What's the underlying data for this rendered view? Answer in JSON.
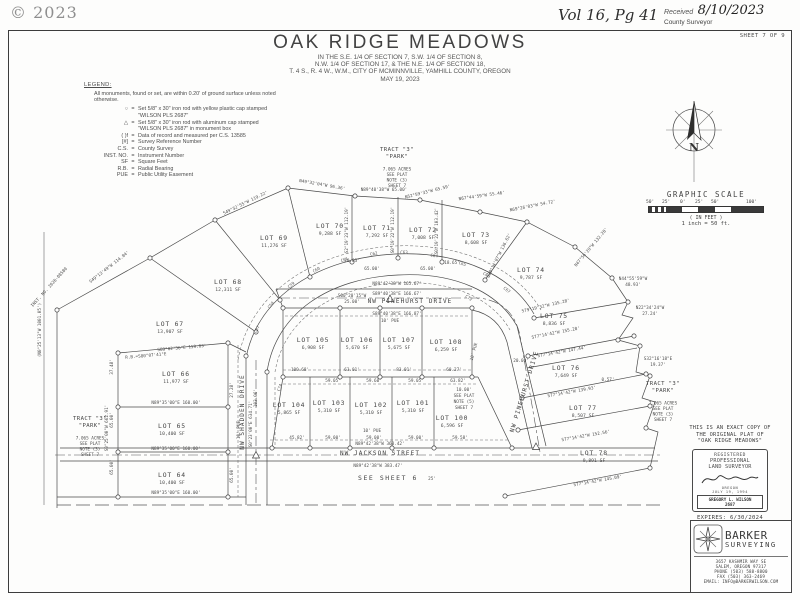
{
  "page": {
    "copyright": "© 2023",
    "vol": "Vol 16, Pg 41",
    "received_label": "Received",
    "received_date": "8/10/2023",
    "county_surveyor": "County Surveyor",
    "sheet": "SHEET 7 OF 9"
  },
  "title": {
    "main": "OAK RIDGE MEADOWS",
    "sub1": "IN THE S.E. 1/4 OF SECTION 7, S.W. 1/4 OF SECTION 8,",
    "sub2": "N.W. 1/4 OF SECTION 17, & THE N.E. 1/4 OF SECTION 18,",
    "sub3": "T. 4 S., R. 4 W., W.M., CITY OF MCMINNVILLE, YAMHILL COUNTY, OREGON",
    "sub4": "MAY 19, 2023"
  },
  "legend": {
    "heading": "LEGEND:",
    "note": "All monuments, found or set, are within 0.20' of ground surface unless noted otherwise.",
    "eq": "=",
    "items": [
      {
        "symbol": "○",
        "lines": [
          "Set 5/8\" x 30\" iron rod with yellow plastic cap stamped",
          "\"WILSON PLS 2687\""
        ]
      },
      {
        "symbol": "△",
        "lines": [
          "Set 5/8\" x 30\" iron rod with aluminum cap stamped",
          "\"WILSON PLS 2687\" in monument box"
        ]
      },
      {
        "symbol": "( )f",
        "lines": [
          "Data of record and measured per C.S. 13585"
        ]
      },
      {
        "symbol": "[#]",
        "lines": [
          "Survey Reference Number"
        ]
      },
      {
        "symbol": "C.S.",
        "lines": [
          "County Survey"
        ]
      },
      {
        "symbol": "INST. NO.",
        "lines": [
          "Instrument Number"
        ]
      },
      {
        "symbol": "SF",
        "lines": [
          "Square Feet"
        ]
      },
      {
        "symbol": "R.B.",
        "lines": [
          "Radial Bearing"
        ]
      },
      {
        "symbol": "PUE",
        "lines": [
          "Public Utility Easement"
        ]
      }
    ]
  },
  "compass": {
    "letter": "N"
  },
  "scale": {
    "title": "GRAPHIC SCALE",
    "ticks": [
      "50'",
      "25'",
      "0'",
      "25'",
      "50'",
      "100'"
    ],
    "feet": "( IN FEET )",
    "ratio": "1 inch = 50 ft."
  },
  "certification": {
    "l1": "THIS IS AN EXACT COPY OF",
    "l2": "THE ORIGINAL PLAT OF",
    "l3": "\"OAK RIDGE MEADOWS\"",
    "stamp": {
      "registered": "REGISTERED",
      "professional": "PROFESSIONAL",
      "land_surveyor": "LAND SURVEYOR",
      "state": "OREGON",
      "date": "JULY 19, 1994",
      "name": "GREGORY L. WILSON",
      "number": "2687"
    },
    "expires": "EXPIRES: 6/30/2024"
  },
  "firm": {
    "name": "BARKER",
    "type": "SURVEYING",
    "address1": "3657 KASHMIR WAY SE",
    "address2": "SALEM, OREGON 97317",
    "phone": "PHONE (503) 588-8800",
    "fax": "FAX (503) 363-2469",
    "email": "EMAIL: INFO@BARKERWILSON.COM"
  },
  "map": {
    "see_sheet": "SEE SHEET 6",
    "streets": [
      {
        "name": "NW PINEHURST DRIVE",
        "x": 410,
        "y": 303,
        "r": 0
      },
      {
        "name": "NW JACKSON STREET",
        "x": 380,
        "y": 455,
        "r": 0
      },
      {
        "name": "NW SHADDEN DRIVE",
        "x": 244,
        "y": 412,
        "r": -90
      },
      {
        "name": "NW PINEHURST DRIVE",
        "x": 526,
        "y": 392,
        "r": -73
      }
    ],
    "lots": [
      {
        "name": "LOT 64",
        "sf": "10,400 SF",
        "x": 172,
        "y": 477
      },
      {
        "name": "LOT 65",
        "sf": "10,400 SF",
        "x": 172,
        "y": 428
      },
      {
        "name": "LOT 66",
        "sf": "11,977 SF",
        "x": 176,
        "y": 376
      },
      {
        "name": "LOT 67",
        "sf": "13,907 SF",
        "x": 170,
        "y": 326
      },
      {
        "name": "LOT 68",
        "sf": "12,311 SF",
        "x": 228,
        "y": 284
      },
      {
        "name": "LOT 69",
        "sf": "11,276 SF",
        "x": 274,
        "y": 240
      },
      {
        "name": "LOT 70",
        "sf": "9,288 SF",
        "x": 330,
        "y": 228
      },
      {
        "name": "LOT 71",
        "sf": "7,292 SF",
        "x": 377,
        "y": 230
      },
      {
        "name": "LOT 72",
        "sf": "7,008 SF",
        "x": 423,
        "y": 232
      },
      {
        "name": "LOT 73",
        "sf": "8,608 SF",
        "x": 476,
        "y": 237
      },
      {
        "name": "LOT 74",
        "sf": "9,787 SF",
        "x": 531,
        "y": 272
      },
      {
        "name": "LOT 75",
        "sf": "8,836 SF",
        "x": 554,
        "y": 318
      },
      {
        "name": "LOT 76",
        "sf": "7,649 SF",
        "x": 566,
        "y": 370
      },
      {
        "name": "LOT 77",
        "sf": "8,507 SF",
        "x": 583,
        "y": 410
      },
      {
        "name": "LOT 78",
        "sf": "9,891 SF",
        "x": 594,
        "y": 455
      },
      {
        "name": "LOT 100",
        "sf": "6,596 SF",
        "x": 452,
        "y": 420
      },
      {
        "name": "LOT 101",
        "sf": "5,310 SF",
        "x": 413,
        "y": 405
      },
      {
        "name": "LOT 102",
        "sf": "5,310 SF",
        "x": 371,
        "y": 407
      },
      {
        "name": "LOT 103",
        "sf": "5,310 SF",
        "x": 329,
        "y": 405
      },
      {
        "name": "LOT 104",
        "sf": "5,865 SF",
        "x": 289,
        "y": 407
      },
      {
        "name": "LOT 105",
        "sf": "6,908 SF",
        "x": 313,
        "y": 342
      },
      {
        "name": "LOT 106",
        "sf": "5,670 SF",
        "x": 357,
        "y": 342
      },
      {
        "name": "LOT 107",
        "sf": "5,675 SF",
        "x": 399,
        "y": 342
      },
      {
        "name": "LOT 108",
        "sf": "6,259 SF",
        "x": 446,
        "y": 344
      }
    ],
    "tracts": [
      {
        "x": 397,
        "y": 151,
        "lines": [
          "TRACT \"3\"",
          "\"PARK\"",
          "7.065 ACRES",
          "SEE PLAT",
          "NOTE (3)",
          "SHEET 7"
        ]
      },
      {
        "x": 90,
        "y": 420,
        "lines": [
          "TRACT \"3\"",
          "\"PARK\"",
          "7.065 ACRES",
          "SEE PLAT",
          "NOTE (3)",
          "SHEET 7"
        ]
      },
      {
        "x": 663,
        "y": 385,
        "lines": [
          "TRACT \"3\"",
          "\"PARK\"",
          "7.065 ACRES",
          "SEE PLAT",
          "NOTE (3)",
          "SHEET 7"
        ]
      }
    ],
    "bearings": [
      {
        "t": "S49°13'49\"W 114.84'",
        "x": 110,
        "y": 268,
        "r": -38
      },
      {
        "t": "S49°32'55\"W 119.22'",
        "x": 246,
        "y": 204,
        "r": -26
      },
      {
        "t": "N49°32'04\"W 96.36'",
        "x": 322,
        "y": 186,
        "r": 10
      },
      {
        "t": "N89°40'38\"W 65.00'",
        "x": 384,
        "y": 191,
        "r": 0
      },
      {
        "t": "N52°59'33\"W 65.59'",
        "x": 428,
        "y": 193,
        "r": -14
      },
      {
        "t": "N67°44'59\"W 55.46'",
        "x": 482,
        "y": 197,
        "r": -8
      },
      {
        "t": "N69°26'03\"W 54.72'",
        "x": 533,
        "y": 207,
        "r": -11
      },
      {
        "t": "N47°56'20\"W 132.28'",
        "x": 592,
        "y": 248,
        "r": -50
      },
      {
        "t": "S30°14'07\"W 136.62'",
        "x": 500,
        "y": 256,
        "r": -63
      },
      {
        "t": "S2°19'23\"W 112.19'",
        "x": 348,
        "y": 230,
        "r": -90
      },
      {
        "t": "S0°19'22\"W 112.19'",
        "x": 394,
        "y": 230,
        "r": -90
      },
      {
        "t": "S0°19'22\"W 103.42'",
        "x": 438,
        "y": 231,
        "r": -90
      },
      {
        "t": "N44°55'59\"W",
        "x": 633,
        "y": 280,
        "r": 0
      },
      {
        "t": "48.93'",
        "x": 633,
        "y": 286,
        "r": 0
      },
      {
        "t": "N22°34'24\"W",
        "x": 650,
        "y": 309,
        "r": 0
      },
      {
        "t": "27.24'",
        "x": 650,
        "y": 315,
        "r": 0
      },
      {
        "t": "S32°16'18\"E",
        "x": 658,
        "y": 360,
        "r": 0
      },
      {
        "t": "19.37'",
        "x": 658,
        "y": 366,
        "r": 0
      },
      {
        "t": "S79°19'32\"W 135.28'",
        "x": 546,
        "y": 307,
        "r": -13
      },
      {
        "t": "S77°14'42\"W 155.28'",
        "x": 556,
        "y": 334,
        "r": -11
      },
      {
        "t": "S77°14'42\"W 147.44'",
        "x": 562,
        "y": 353,
        "r": -10
      },
      {
        "t": "S77°14'42\"W 139.93'",
        "x": 572,
        "y": 393,
        "r": -10
      },
      {
        "t": "S77°14'42\"W 152.56'",
        "x": 586,
        "y": 437,
        "r": -10
      },
      {
        "t": "S77°14'42\"W 145.09'",
        "x": 598,
        "y": 482,
        "r": -10
      },
      {
        "t": "20.00'",
        "x": 521,
        "y": 362,
        "r": 0
      },
      {
        "t": "0.57'",
        "x": 608,
        "y": 381,
        "r": 0
      },
      {
        "t": "N89°42'38\"W 165.67'",
        "x": 397,
        "y": 285,
        "r": 0
      },
      {
        "t": "S89°40'38\"E 166.67'",
        "x": 397,
        "y": 295,
        "r": 0
      },
      {
        "t": "S89°40'38\"E 166.87'",
        "x": 397,
        "y": 315,
        "r": 0
      },
      {
        "t": "S00°20'15\"W",
        "x": 352,
        "y": 297,
        "r": 0
      },
      {
        "t": "25.00'",
        "x": 352,
        "y": 303,
        "r": 0
      },
      {
        "t": "N89°42'38\"W 360.42'",
        "x": 380,
        "y": 445,
        "r": 0
      },
      {
        "t": "N89°42'38\"W 383.47'",
        "x": 378,
        "y": 467,
        "r": 0
      },
      {
        "t": "S89°02'36\"E 159.83'",
        "x": 182,
        "y": 349,
        "r": -5
      },
      {
        "t": "R.B.=S80°07'41\"E",
        "x": 146,
        "y": 357,
        "r": -5
      },
      {
        "t": "N89°35'00\"E 160.00'",
        "x": 176,
        "y": 404,
        "r": 0
      },
      {
        "t": "N89°35'00\"E 160.00'",
        "x": 176,
        "y": 450,
        "r": 0
      },
      {
        "t": "N89°35'00\"E 160.00'",
        "x": 176,
        "y": 494,
        "r": 0
      },
      {
        "t": "S0°25'00\"W 662.91'",
        "x": 108,
        "y": 428,
        "r": -90
      },
      {
        "t": "(N0°25'13\"W 1001.05')",
        "x": 41,
        "y": 330,
        "r": -90
      },
      {
        "t": "S0°23'00\"E 634.71'",
        "x": 252,
        "y": 424,
        "r": -90
      },
      {
        "t": "INST. NO. 2020-08580",
        "x": 50,
        "y": 288,
        "r": -48
      },
      {
        "t": "20.03'",
        "x": 352,
        "y": 262,
        "r": 0
      },
      {
        "t": "18.65'",
        "x": 452,
        "y": 264,
        "r": 0
      },
      {
        "t": "65.00'",
        "x": 372,
        "y": 270,
        "r": 0
      },
      {
        "t": "65.00'",
        "x": 428,
        "y": 270,
        "r": 0
      },
      {
        "t": "100.68'",
        "x": 300,
        "y": 371,
        "r": 0
      },
      {
        "t": "63.01'",
        "x": 352,
        "y": 371,
        "r": 0
      },
      {
        "t": "83.01'",
        "x": 404,
        "y": 371,
        "r": 0
      },
      {
        "t": "60.27'",
        "x": 454,
        "y": 371,
        "r": 0
      },
      {
        "t": "59.05'",
        "x": 333,
        "y": 382,
        "r": 0
      },
      {
        "t": "59.60'",
        "x": 374,
        "y": 382,
        "r": 0
      },
      {
        "t": "59.05'",
        "x": 416,
        "y": 382,
        "r": 0
      },
      {
        "t": "63.82'",
        "x": 458,
        "y": 382,
        "r": 0
      },
      {
        "t": "45.82'",
        "x": 297,
        "y": 439,
        "r": 0
      },
      {
        "t": "59.00'",
        "x": 333,
        "y": 439,
        "r": 0
      },
      {
        "t": "59.00'",
        "x": 374,
        "y": 439,
        "r": 0
      },
      {
        "t": "59.00'",
        "x": 416,
        "y": 439,
        "r": 0
      },
      {
        "t": "59.58'",
        "x": 460,
        "y": 439,
        "r": 0
      },
      {
        "t": "37.48'",
        "x": 113,
        "y": 367,
        "r": -90
      },
      {
        "t": "65.00'",
        "x": 113,
        "y": 420,
        "r": -90
      },
      {
        "t": "65.00'",
        "x": 113,
        "y": 467,
        "r": -90
      },
      {
        "t": "27.28'",
        "x": 233,
        "y": 390,
        "r": -90
      },
      {
        "t": "65.00'",
        "x": 233,
        "y": 475,
        "r": -90
      },
      {
        "t": "103.06'",
        "x": 257,
        "y": 398,
        "r": -90
      },
      {
        "t": "10' PUE",
        "x": 390,
        "y": 322,
        "r": 0
      },
      {
        "t": "10' PUE",
        "x": 372,
        "y": 432,
        "r": 0
      },
      {
        "t": "10' PUE",
        "x": 240,
        "y": 430,
        "r": -90
      },
      {
        "t": "10' PUE",
        "x": 475,
        "y": 352,
        "r": -75
      },
      {
        "t": "10.00'",
        "x": 464,
        "y": 391,
        "r": 0
      },
      {
        "t": "SEE PLAT",
        "x": 464,
        "y": 397,
        "r": 0
      },
      {
        "t": "NOTE (5)",
        "x": 464,
        "y": 403,
        "r": 0
      },
      {
        "t": "SHEET 7",
        "x": 464,
        "y": 409,
        "r": 0
      },
      {
        "t": "25'",
        "x": 432,
        "y": 480,
        "r": 0
      }
    ],
    "curves": [
      {
        "t": "C57",
        "x": 258,
        "y": 330,
        "r": -60
      },
      {
        "t": "C58",
        "x": 272,
        "y": 306,
        "r": -50
      },
      {
        "t": "C59",
        "x": 292,
        "y": 286,
        "r": -40
      },
      {
        "t": "C60",
        "x": 317,
        "y": 271,
        "r": -30
      },
      {
        "t": "C61",
        "x": 345,
        "y": 261,
        "r": -20
      },
      {
        "t": "C62",
        "x": 374,
        "y": 255,
        "r": -10
      },
      {
        "t": "C63",
        "x": 404,
        "y": 254,
        "r": 0
      },
      {
        "t": "C64",
        "x": 434,
        "y": 257,
        "r": 8
      },
      {
        "t": "C65",
        "x": 462,
        "y": 265,
        "r": 18
      },
      {
        "t": "C66",
        "x": 486,
        "y": 276,
        "r": 28
      },
      {
        "t": "C67",
        "x": 506,
        "y": 291,
        "r": 38
      },
      {
        "t": "C72",
        "x": 468,
        "y": 299,
        "r": 35
      },
      {
        "t": "C74",
        "x": 281,
        "y": 388,
        "r": -70
      }
    ]
  }
}
